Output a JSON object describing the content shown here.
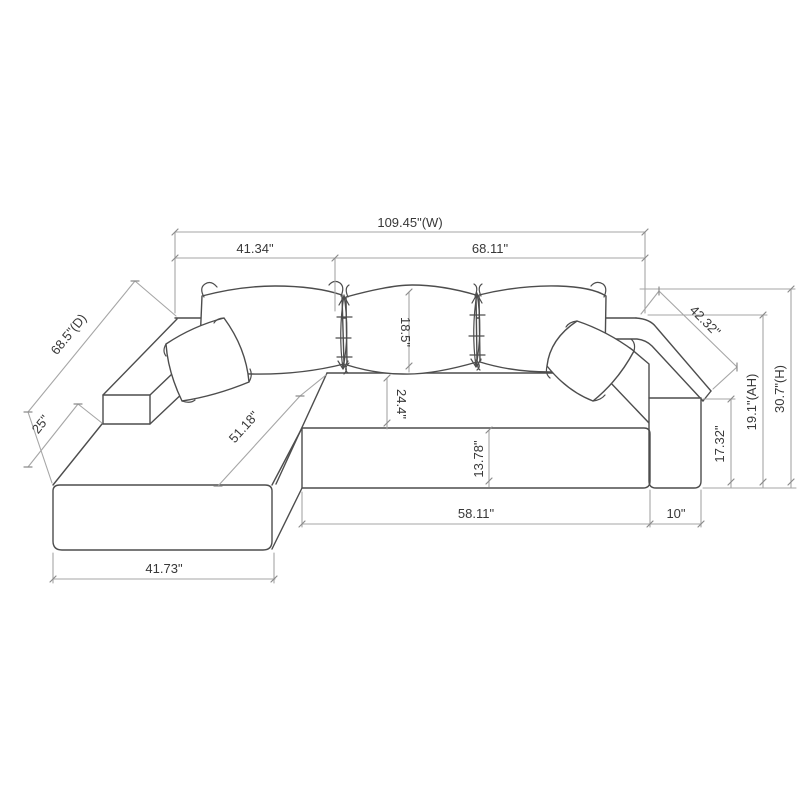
{
  "diagram": {
    "title": "sectional-sofa-dimension-drawing",
    "accent_line_color": "#4d4d4d",
    "dimension_line_color": "#a6a6a6",
    "labels": {
      "overall_width": "109.45\"(W)",
      "left_width": "41.34\"",
      "right_width": "68.11\"",
      "depth": "68.5\"(D)",
      "chaise_front": "25\"",
      "chaise_length": "51.18\"",
      "back_cushion_height": "18.5\"",
      "seat_depth": "24.4\"",
      "seat_front_height": "13.78\"",
      "seat_width": "58.11\"",
      "arm_width": "10\"",
      "seat_height": "17.32\"",
      "arm_height": "19.1\"(AH)",
      "overall_height": "30.7\"(H)",
      "right_arm_depth": "42.32\"",
      "chaise_width": "41.73\""
    }
  }
}
